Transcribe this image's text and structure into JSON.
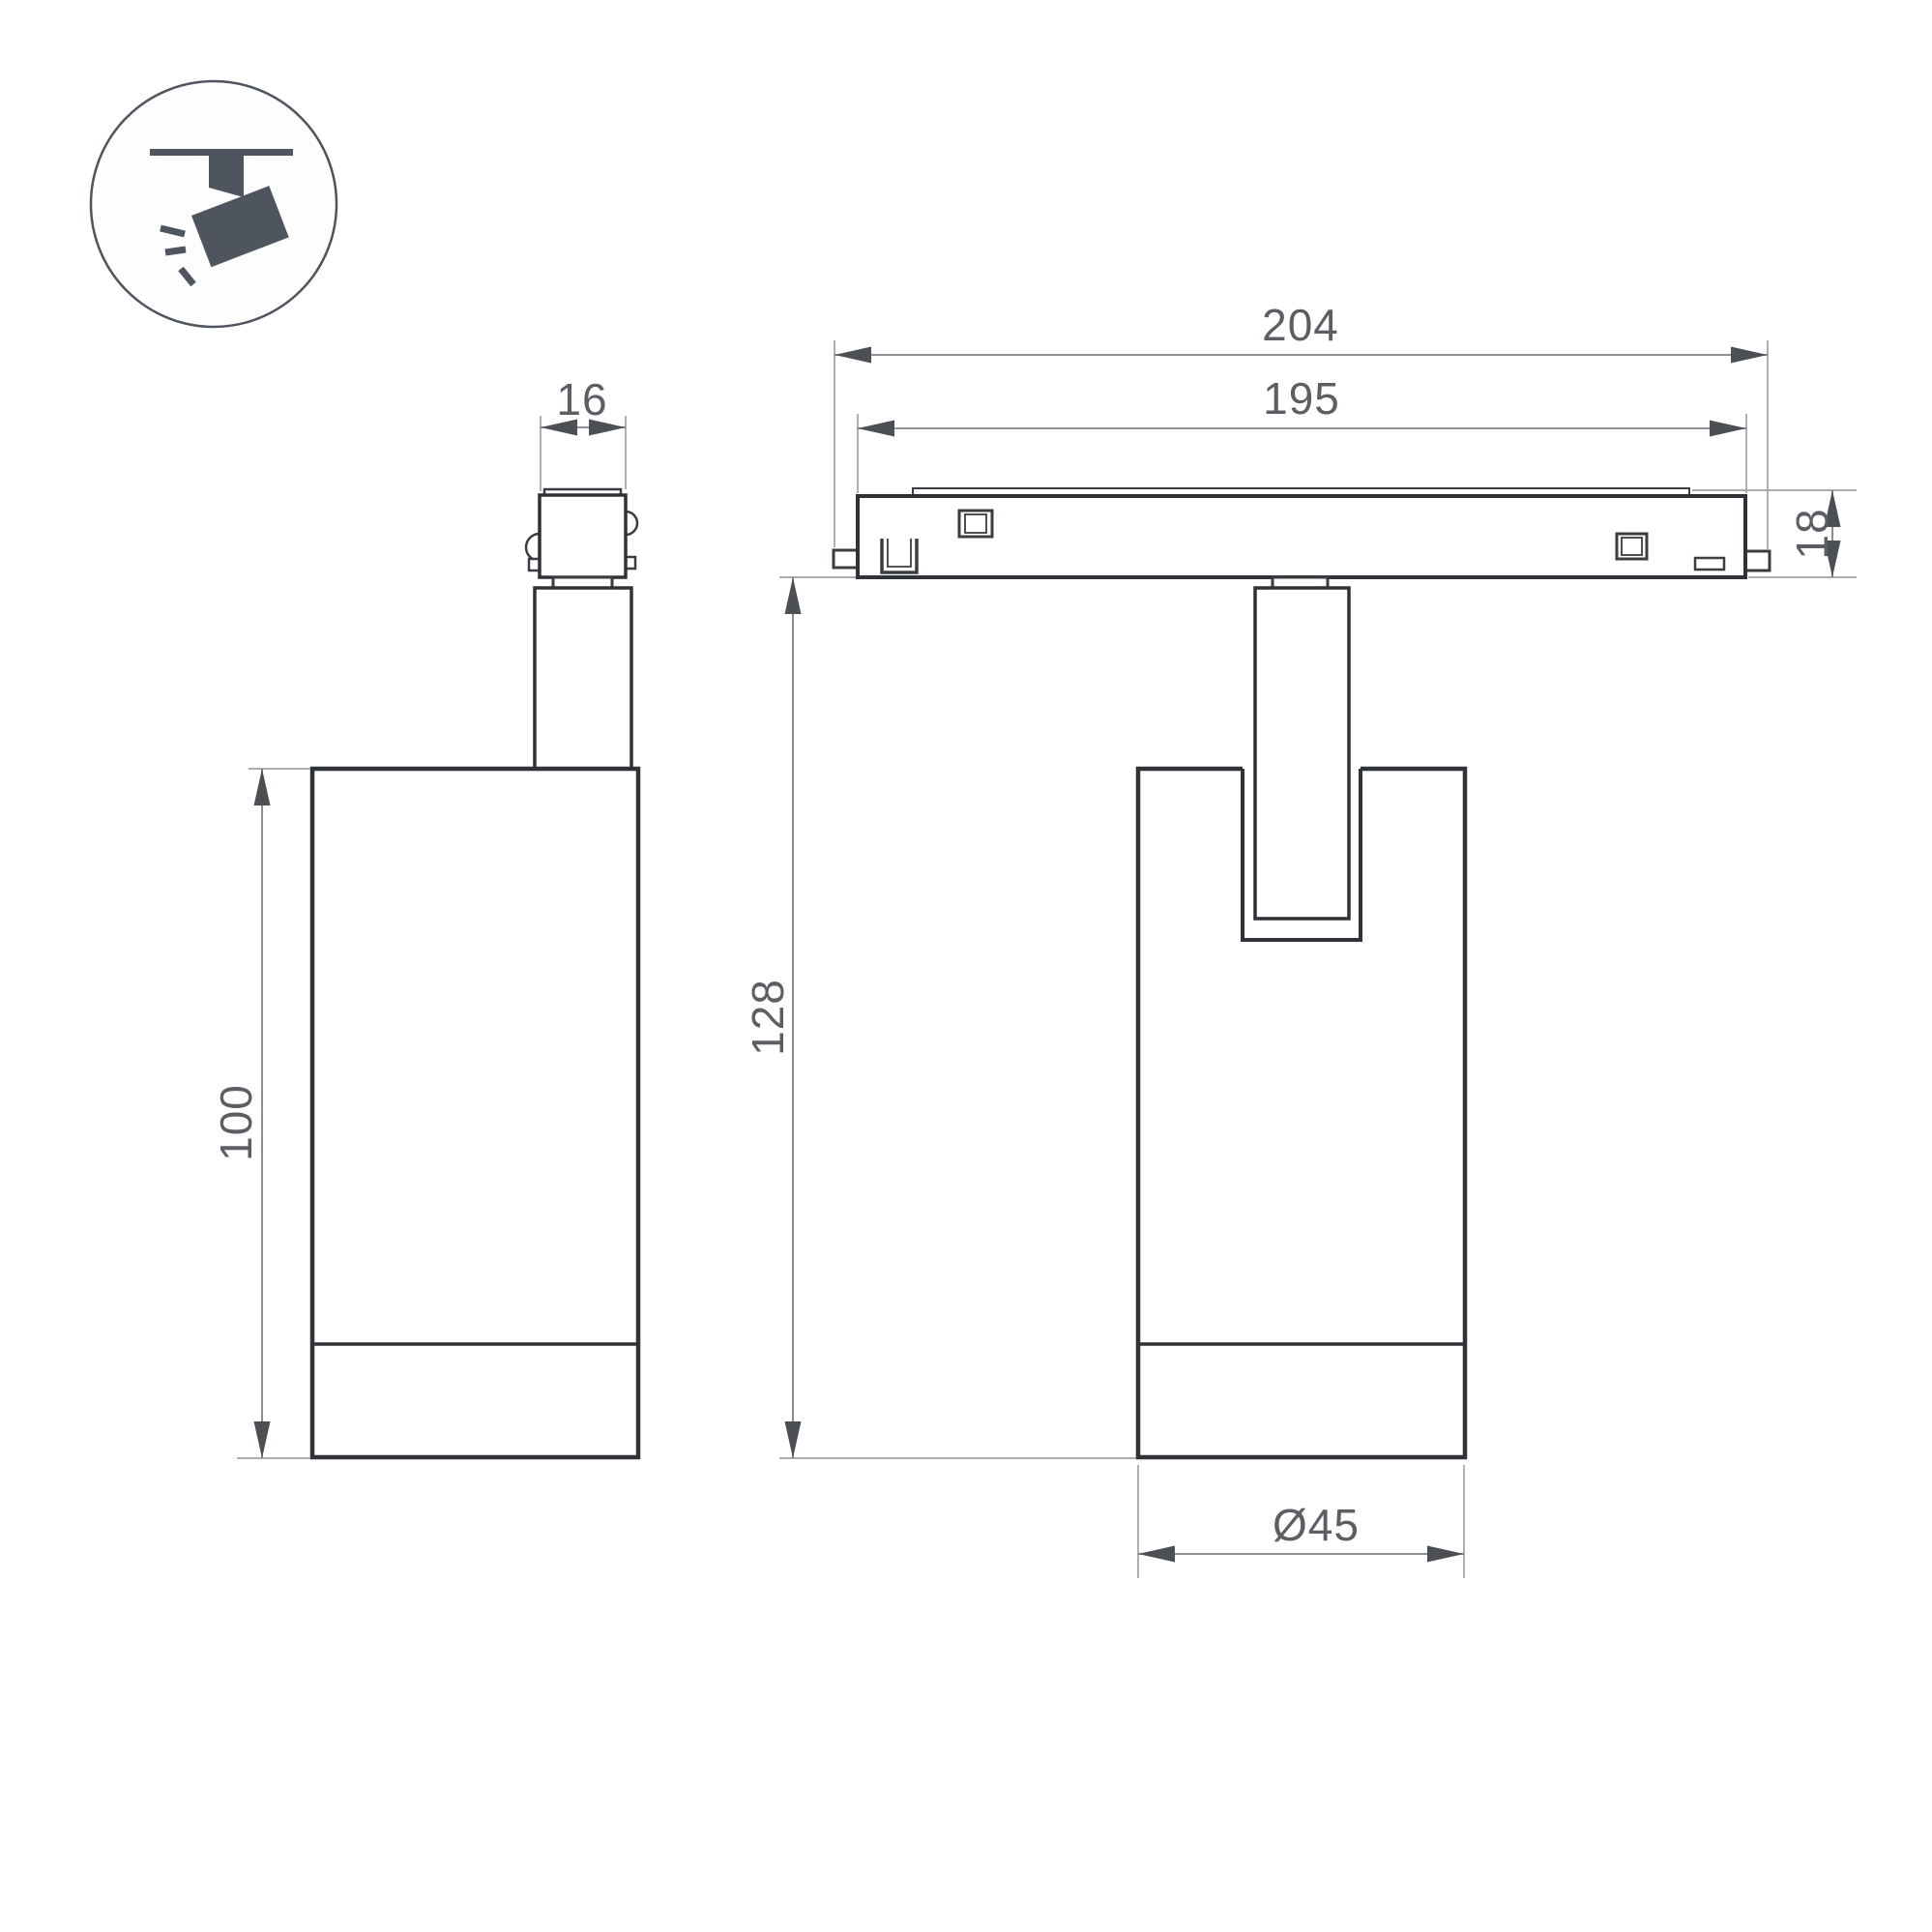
{
  "page": {
    "title": "Track spotlight dimensional drawing"
  },
  "icon": {
    "name": "ceiling-track-spotlight-icon"
  },
  "dims": {
    "adapter_width": {
      "label": "16"
    },
    "overall_length": {
      "label": "204"
    },
    "track_body_length": {
      "label": "195"
    },
    "track_height": {
      "label": "18"
    },
    "overall_height": {
      "label": "128"
    },
    "body_height": {
      "label": "100"
    },
    "body_diameter": {
      "label": "Ø45"
    }
  },
  "colors": {
    "bg": "#ffffff",
    "outline": "#2f3237",
    "detail": "#3a3d41",
    "dim": "#7e8185",
    "ext": "#9fa2a5",
    "arrow": "#4c4f54",
    "text": "#5b5f64",
    "icon": "#4e555e"
  }
}
